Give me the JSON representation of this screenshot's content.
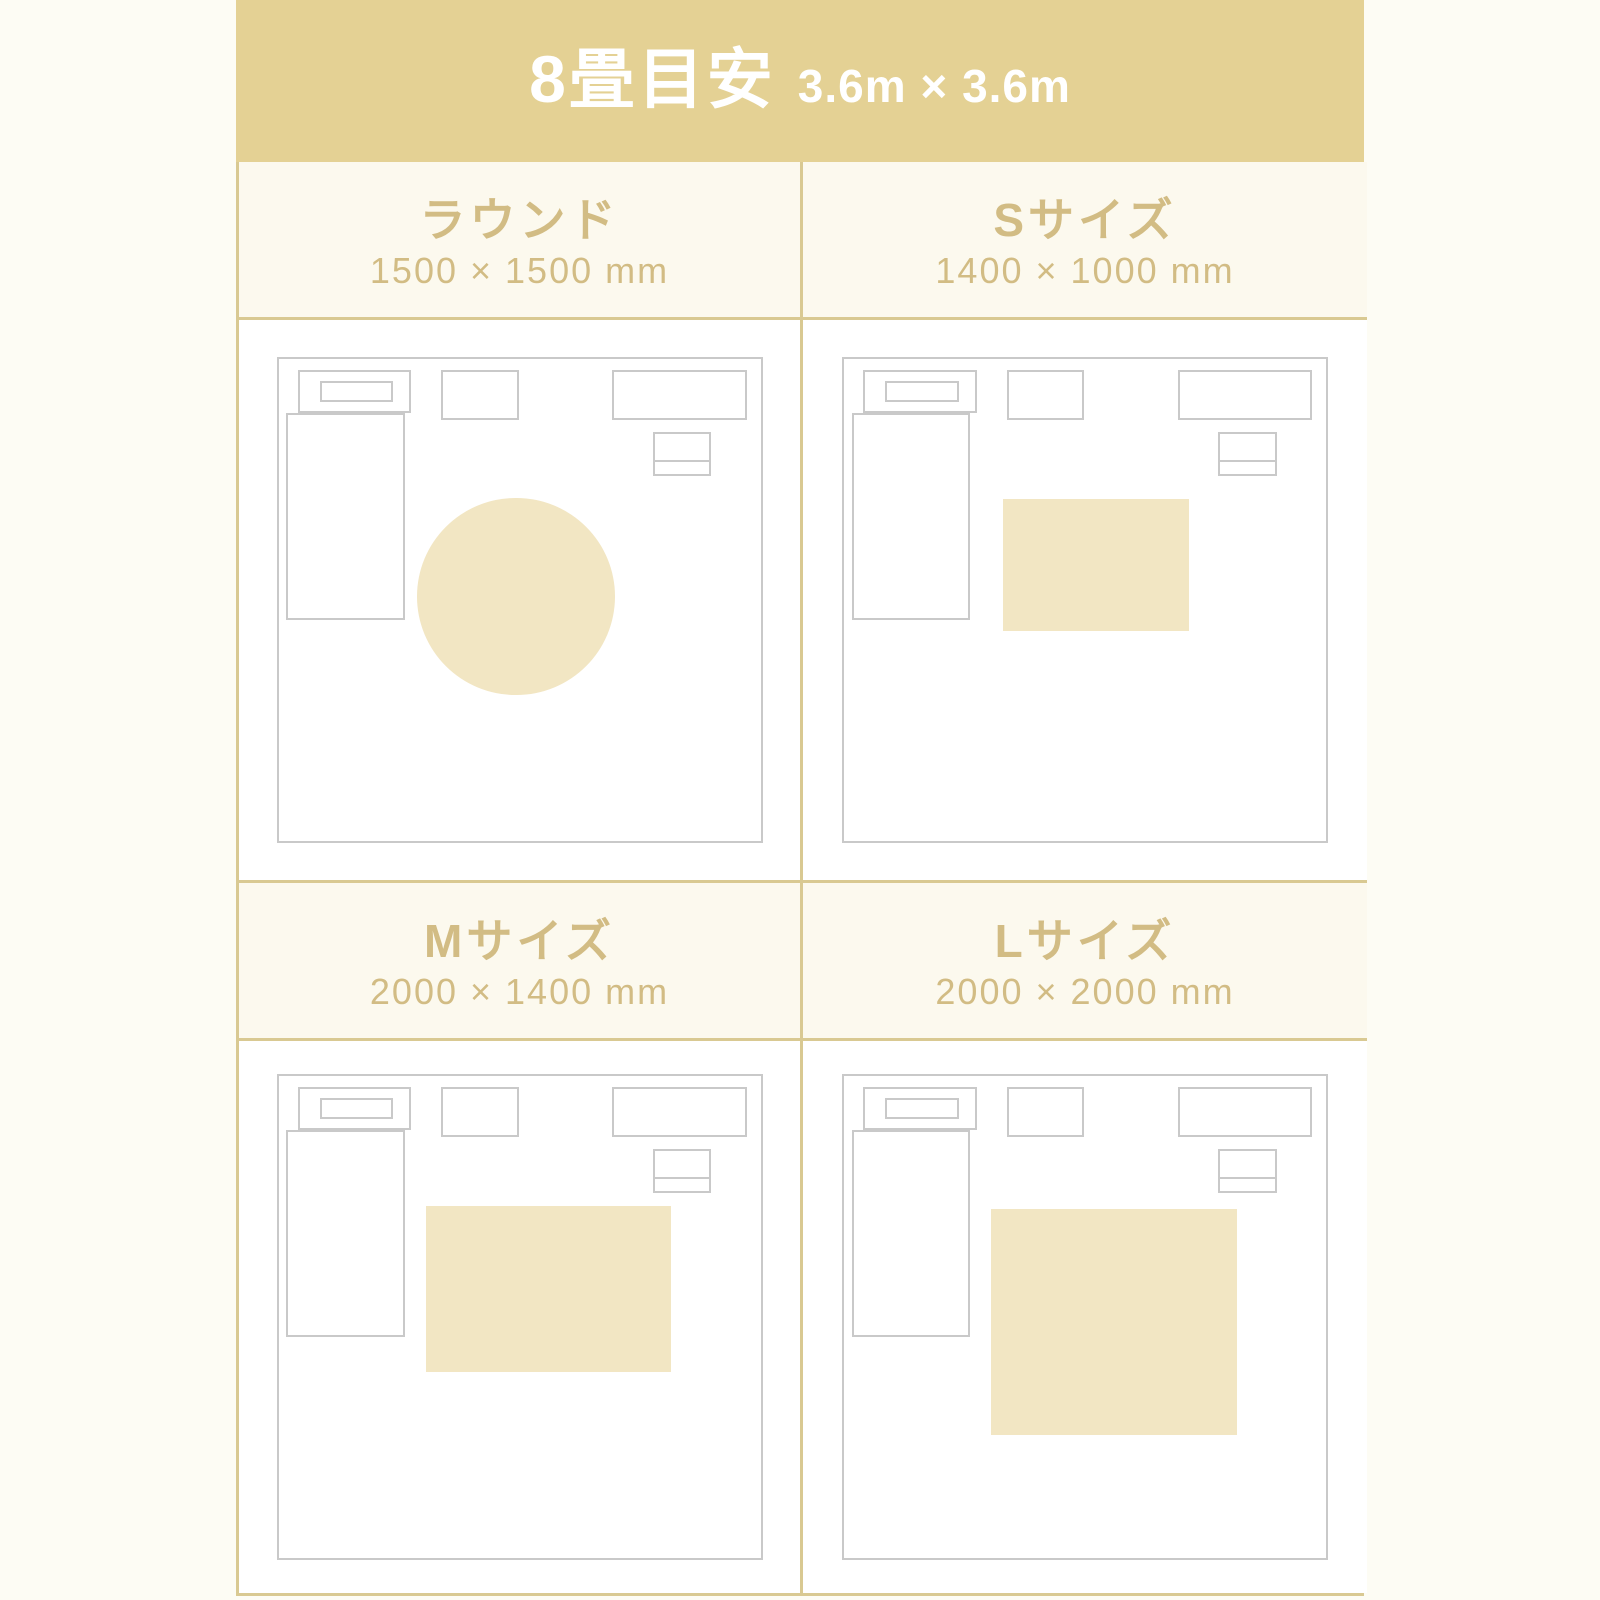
{
  "header": {
    "title": "8畳目安",
    "subtitle": "3.6m × 3.6m"
  },
  "panels": [
    {
      "title": "ラウンド",
      "size": "1500 × 1500 mm",
      "rug_shape": "round-circle"
    },
    {
      "title": "Sサイズ",
      "size": "1400 × 1000 mm",
      "rug_shape": "rectangle"
    },
    {
      "title": "Mサイズ",
      "size": "2000 × 1400 mm",
      "rug_shape": "rectangle"
    },
    {
      "title": "Lサイズ",
      "size": "2000 × 2000 mm",
      "rug_shape": "rectangle"
    }
  ],
  "colors": {
    "page_bg": "#fdfcf4",
    "band_bg": "#e4d194",
    "band_text": "#ffffff",
    "panel_header_bg": "#fcf9ee",
    "accent_text": "#d2bc84",
    "border_gold": "#d9c992",
    "furniture_outline": "#c9c9c9",
    "rug_fill": "#f2e6c3",
    "diagram_bg": "#ffffff"
  }
}
